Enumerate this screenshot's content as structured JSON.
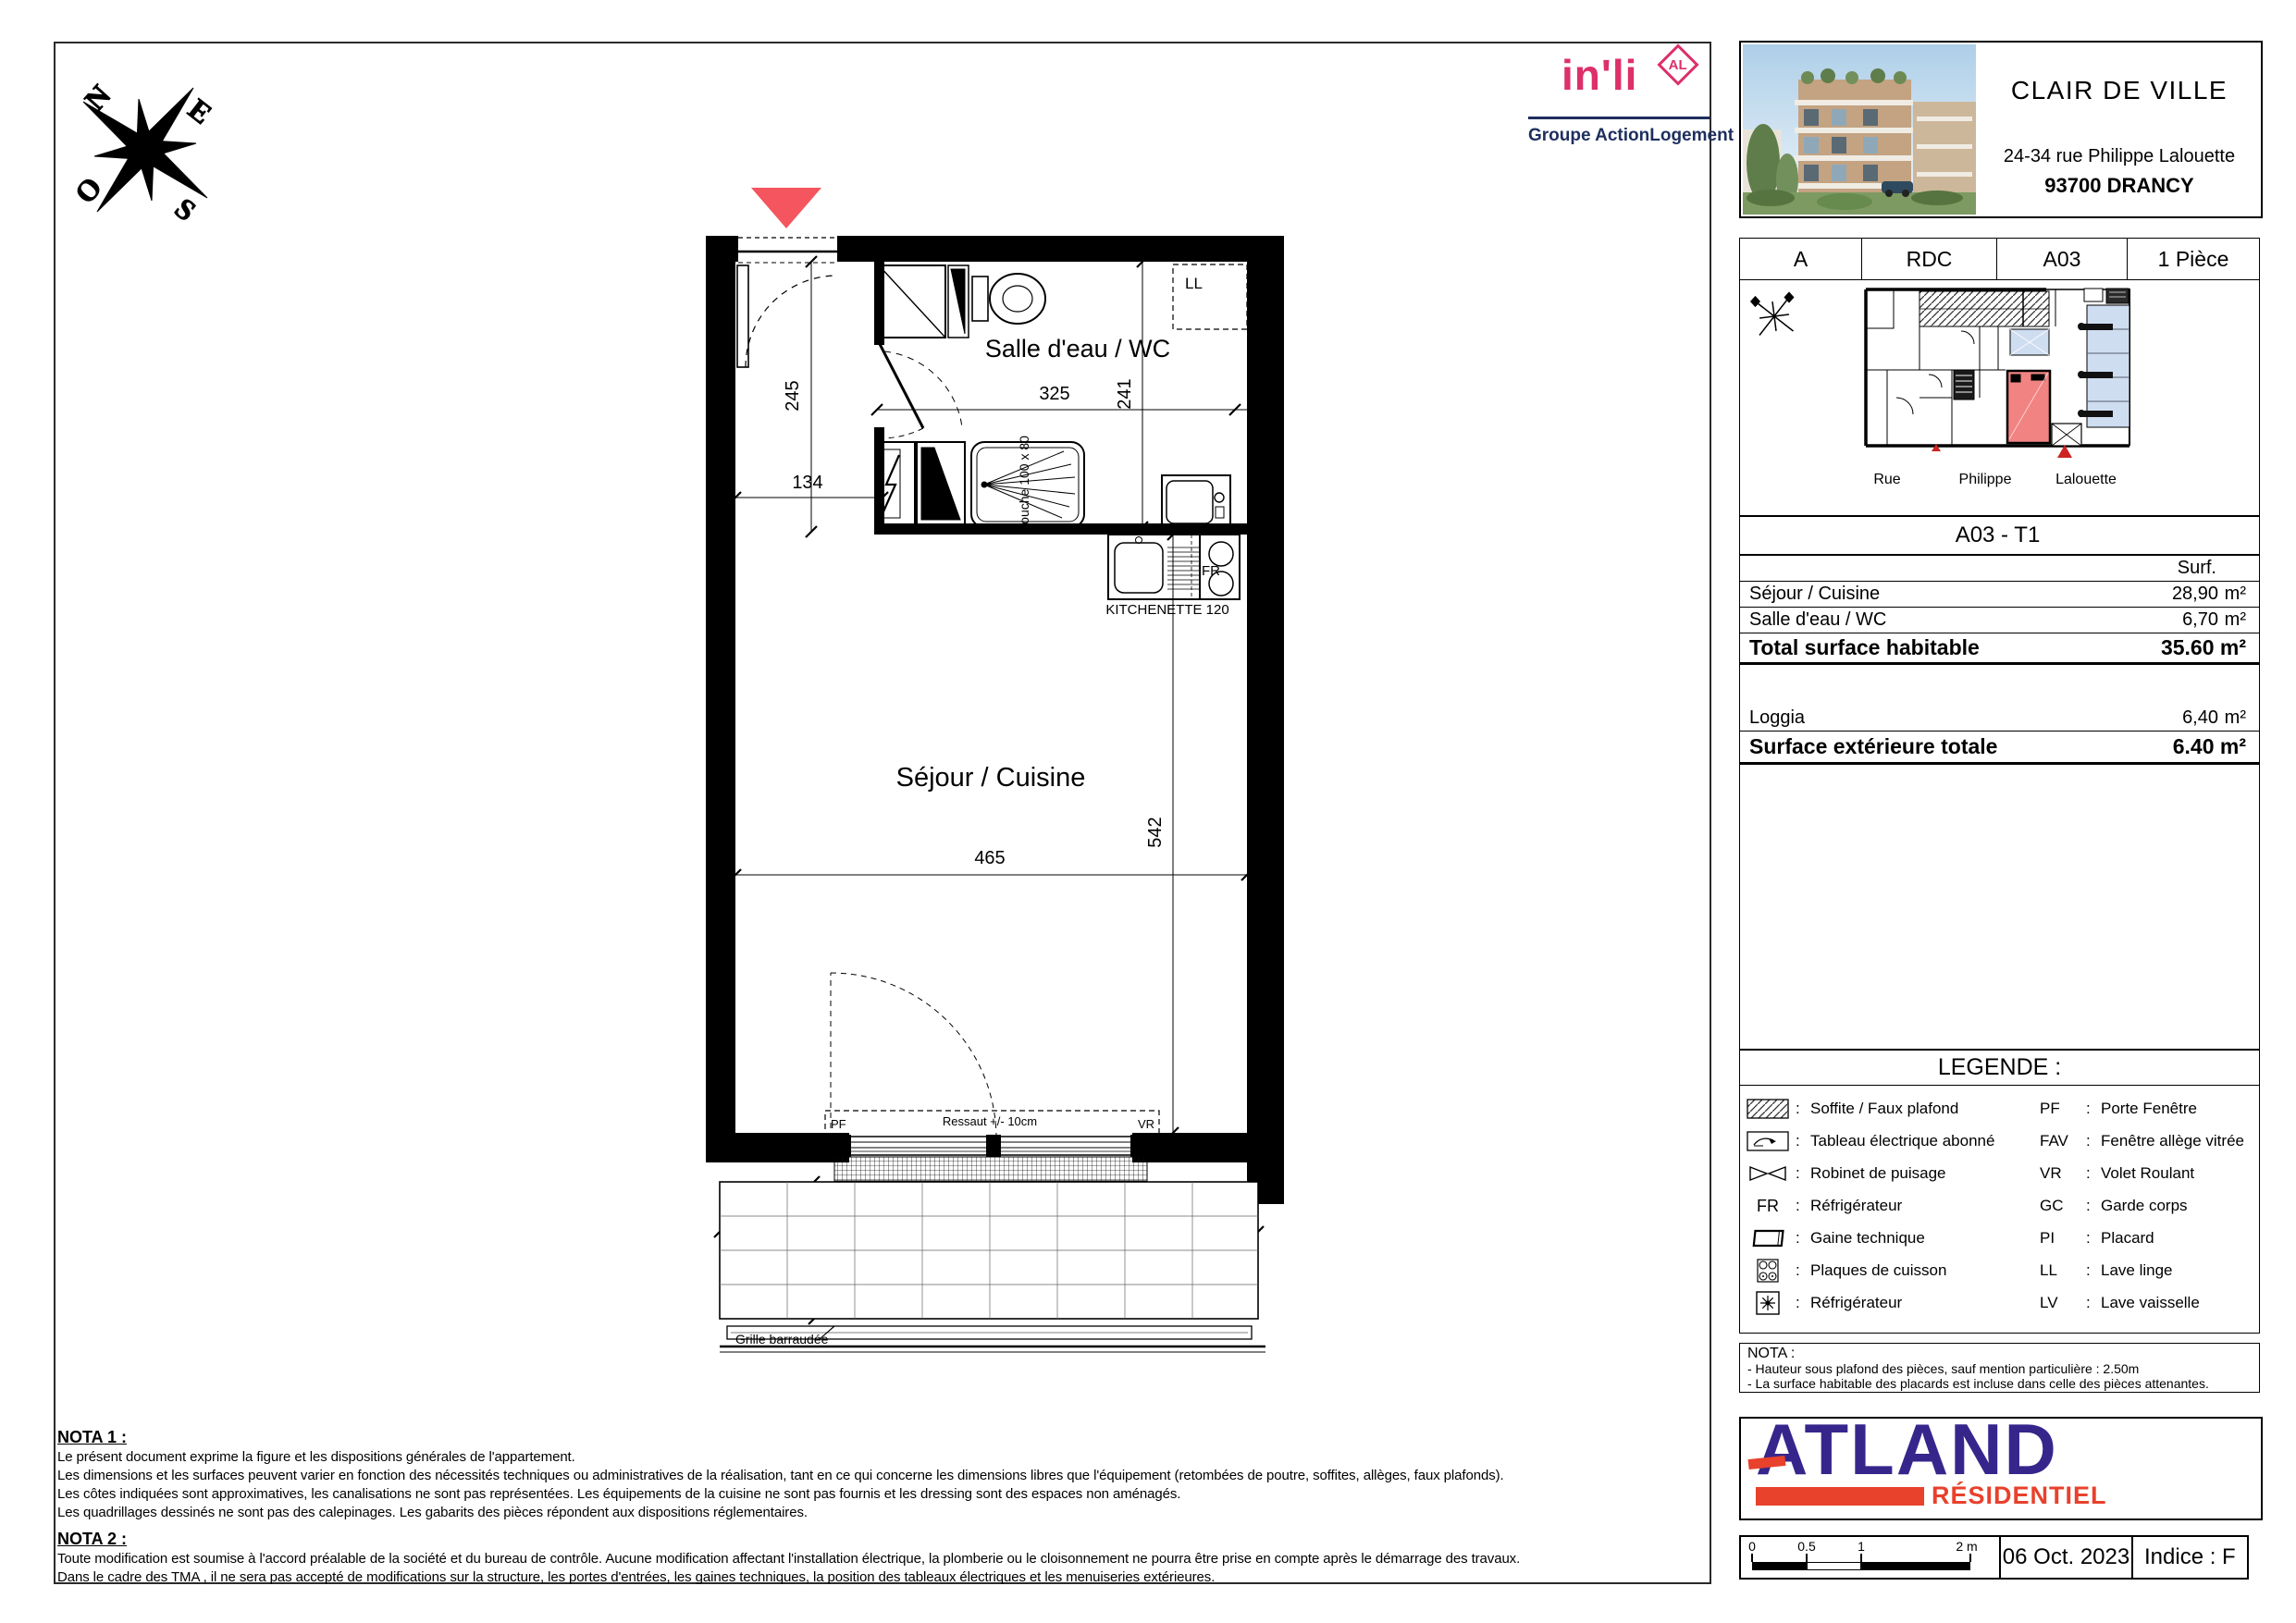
{
  "branding": {
    "inli": {
      "name": "in'li",
      "badge": "AL",
      "tagline": "Groupe ActionLogement",
      "pink": "#dd3069",
      "navy": "#1e2f5e"
    },
    "atland": {
      "name": "ATLAND",
      "sub": "RÉSIDENTIEL",
      "purple": "#36268c",
      "red": "#e8412c"
    }
  },
  "title_block": {
    "project": "CLAIR DE VILLE",
    "address": "24-34 rue Philippe Lalouette",
    "city": "93700 DRANCY"
  },
  "unit_banner": {
    "building": "A",
    "level": "RDC",
    "lot": "A03",
    "type": "1 Pièce"
  },
  "site_plan": {
    "streets": [
      "Rue",
      "Philippe",
      "Lalouette"
    ],
    "unit_color": "#f28383",
    "parking_color": "#cfddf1"
  },
  "surface_table": {
    "title": "A03 - T1",
    "col": "Surf.",
    "rows": [
      {
        "label": "Séjour / Cuisine",
        "value": "28,90",
        "unit": "m²"
      },
      {
        "label": "Salle d'eau / WC",
        "value": "6,70",
        "unit": "m²"
      }
    ],
    "total": {
      "label": "Total surface  habitable",
      "value": "35.60 m²"
    },
    "ext_rows": [
      {
        "label": "Loggia",
        "value": "6,40",
        "unit": "m²"
      }
    ],
    "ext_total": {
      "label": "Surface extérieure totale",
      "value": "6.40 m²"
    }
  },
  "legend": {
    "title": "LEGENDE :",
    "colon": ":",
    "left": [
      {
        "icon": "soffite-hatch-icon",
        "label": "Soffite / Faux plafond"
      },
      {
        "icon": "tableau-electrique-icon",
        "label": "Tableau électrique abonné"
      },
      {
        "icon": "robinet-puisage-icon",
        "label": "Robinet de puisage"
      },
      {
        "icon": "fr-abbrev",
        "abbr": "FR",
        "label": "Réfrigérateur"
      },
      {
        "icon": "gaine-technique-icon",
        "label": "Gaine technique"
      },
      {
        "icon": "plaques-cuisson-icon",
        "label": "Plaques de cuisson"
      },
      {
        "icon": "ventilation-icon",
        "label": "Réfrigérateur"
      }
    ],
    "right": [
      {
        "abbr": "PF",
        "label": "Porte Fenêtre"
      },
      {
        "abbr": "FAV",
        "label": "Fenêtre allège vitrée"
      },
      {
        "abbr": "VR",
        "label": "Volet Roulant"
      },
      {
        "abbr": "GC",
        "label": "Garde corps"
      },
      {
        "abbr": "PI",
        "label": "Placard"
      },
      {
        "abbr": "LL",
        "label": "Lave linge"
      },
      {
        "abbr": "LV",
        "label": "Lave vaisselle"
      }
    ]
  },
  "nota_side": {
    "title": "NOTA :",
    "lines": [
      "- Hauteur sous plafond des pièces, sauf mention particulière : 2.50m",
      "- La surface habitable des placards est incluse dans celle des pièces attenantes."
    ]
  },
  "footer": {
    "scale_ticks": [
      "0",
      "0.5",
      "1",
      "2 m"
    ],
    "date": "06 Oct. 2023",
    "indice": "Indice : F"
  },
  "plan": {
    "rooms": {
      "bath": "Salle d'eau / WC",
      "living": "Séjour / Cuisine",
      "loggia": "Loggia"
    },
    "dims": {
      "d245": "245",
      "d134": "134",
      "d325": "325",
      "d241": "241",
      "d465": "465",
      "d542": "542",
      "d489": "489",
      "d124": "124"
    },
    "ann": {
      "kitchenette": "KITCHENETTE 120",
      "douche": "Douche 100 x 80",
      "ll": "LL",
      "fr": "FR",
      "pf": "PF",
      "vr": "VR",
      "ressaut": "Ressaut +/- 10cm",
      "grille": "Grille barraudée"
    },
    "compass": {
      "n": "N",
      "e": "E",
      "s": "S",
      "o": "O"
    }
  },
  "notes": {
    "nota1_title": "NOTA 1 :",
    "nota1_lines": [
      "Le présent document exprime la figure et les dispositions générales de l'appartement.",
      "Les dimensions et les surfaces peuvent varier en fonction des nécessités techniques ou administratives de la réalisation, tant en ce qui concerne les dimensions libres que l'équipement (retombées de poutre, soffites, allèges, faux plafonds).",
      "Les côtes indiquées sont approximatives, les canalisations ne sont pas représentées. Les équipements de la cuisine ne sont pas fournis et les dressing sont des espaces non aménagés.",
      "Les quadrillages dessinés ne sont pas des calepinages. Les gabarits des pièces répondent aux dispositions réglementaires."
    ],
    "nota2_title": "NOTA 2 :",
    "nota2_lines": [
      "Toute modification est soumise à l'accord préalable de la société et du bureau de contrôle. Aucune modification affectant l'installation électrique, la plomberie ou le cloisonnement ne pourra être prise en compte après le démarrage des travaux.",
      "Dans le cadre des TMA , il ne sera pas accepté de modifications sur la structure, les portes d'entrées, les gaines techniques, la position des tableaux électriques et les menuiseries extérieures."
    ]
  }
}
